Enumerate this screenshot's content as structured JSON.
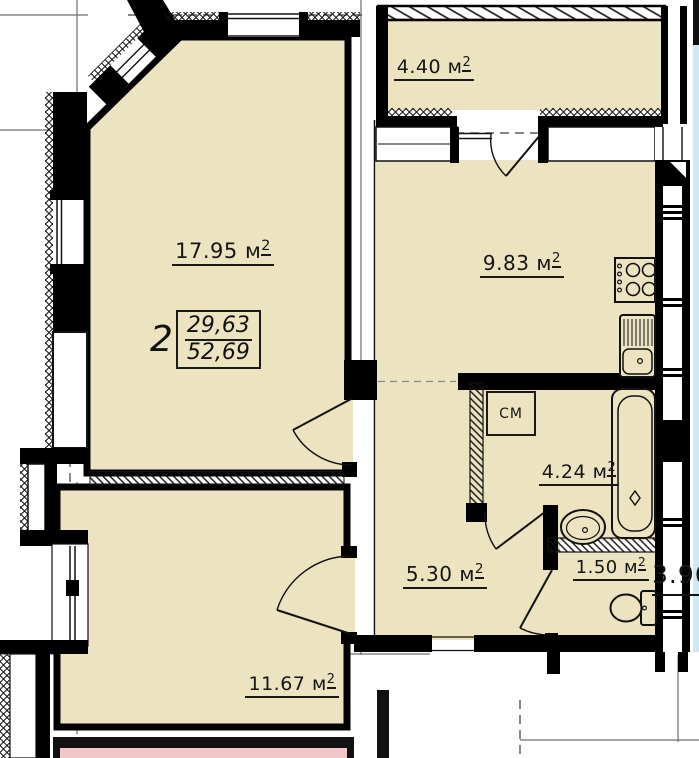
{
  "plan": {
    "type": "apartment-floor-plan",
    "apartment_stamp": {
      "rooms_count": "2",
      "upper_value": "29,63",
      "lower_value": "52,69"
    },
    "rooms": {
      "living": {
        "area": "17.95",
        "unit": "м",
        "sup": "2"
      },
      "balcony": {
        "area": "4.40",
        "unit": "м",
        "sup": "2"
      },
      "kitchen": {
        "area": "9.83",
        "unit": "м",
        "sup": "2"
      },
      "bathroom": {
        "area": "4.24",
        "unit": "м",
        "sup": "2"
      },
      "hall": {
        "area": "5.30",
        "unit": "м",
        "sup": "2"
      },
      "wc": {
        "area": "1.50",
        "unit": "м",
        "sup": "2"
      },
      "bedroom": {
        "area": "11.67",
        "unit": "м",
        "sup": "2"
      }
    },
    "annotations": {
      "washing_machine": "СМ",
      "adjacent_dimension": "3.96"
    },
    "colors": {
      "room_fill": "#ece3c1",
      "adjacent_pink": "#f2c7c9",
      "adjacent_blue": "#cfe9f0",
      "line": "#111111",
      "background": "#ffffff"
    }
  }
}
